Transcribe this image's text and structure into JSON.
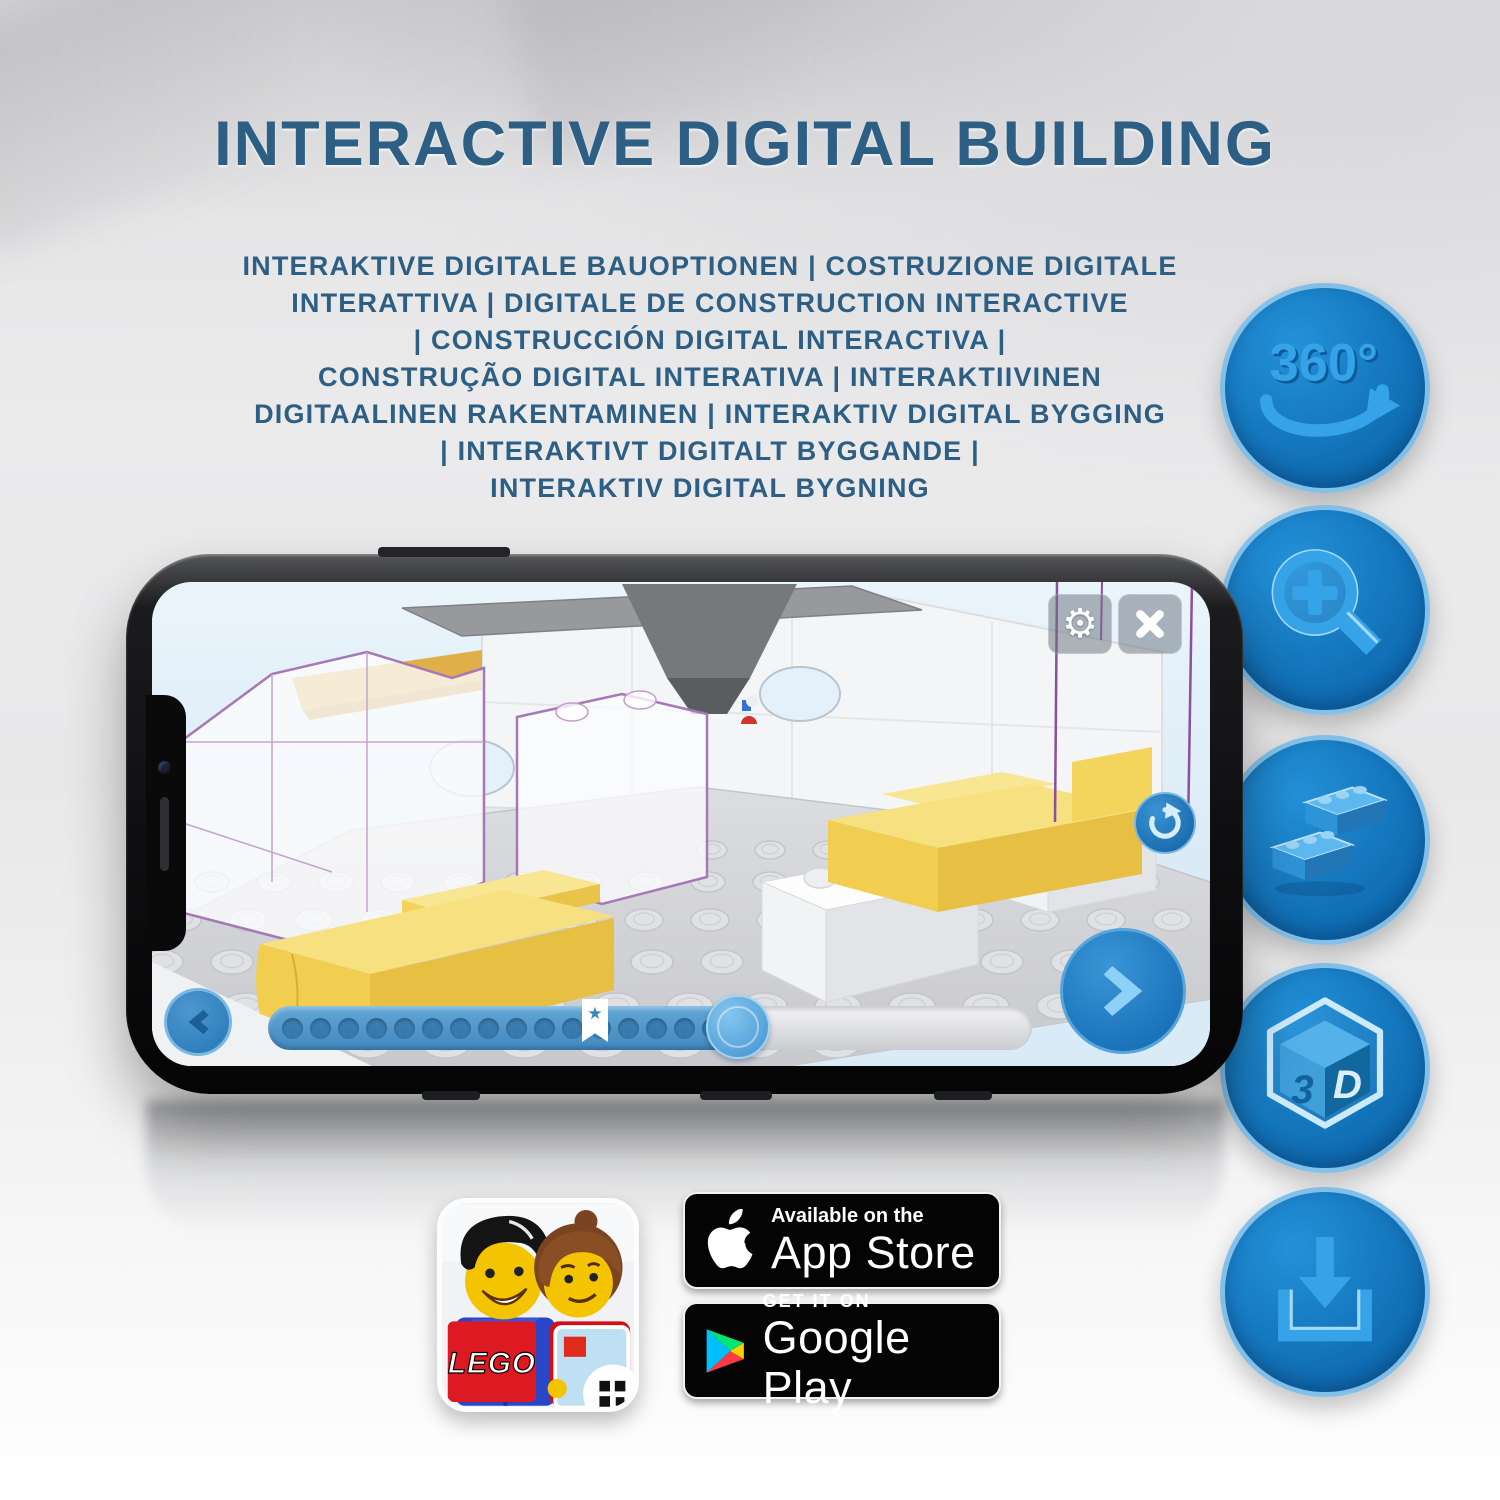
{
  "header": {
    "title": "INTERACTIVE DIGITAL BUILDING"
  },
  "subtitle_lines": [
    "INTERAKTIVE DIGITALE BAUOPTIONEN | COSTRUZIONE DIGITALE",
    "INTERATTIVA | DIGITALE DE CONSTRUCTION INTERACTIVE",
    "| CONSTRUCCIÓN DIGITAL INTERACTIVA |",
    "CONSTRUÇÃO DIGITAL INTERATIVA | INTERAKTIIVINEN",
    "DIGITAALINEN RAKENTAMINEN | INTERAKTIV DIGITAL BYGGING",
    "| INTERAKTIVT DIGITALT BYGGANDE |",
    "INTERAKTIV DIGITAL BYGNING"
  ],
  "feature_icons": [
    {
      "name": "360-rotation",
      "icon": "rotate-360-arrow",
      "label": "360°"
    },
    {
      "name": "zoom",
      "icon": "magnifier-plus"
    },
    {
      "name": "digital-bricks",
      "icon": "two-lego-bricks"
    },
    {
      "name": "3d-view",
      "icon": "3d-cube",
      "cube_left": "3",
      "cube_right": "D"
    },
    {
      "name": "download",
      "icon": "download-tray-arrow"
    }
  ],
  "phone_app": {
    "top_buttons": {
      "settings_icon": "gear",
      "settings_glyph": "⚙",
      "close_icon": "x-mark"
    },
    "viewer_buttons": {
      "rotate_icon": "rotate-clockwise-arrow",
      "previous_icon": "chevron-left",
      "next_icon": "chevron-right"
    },
    "progress_bar": {
      "dot_count": 16,
      "filled_percent": 62,
      "bookmark_icon": "star-bookmark",
      "bookmark_glyph": "★"
    }
  },
  "app_links": {
    "lego_app_icon": {
      "wordmark": "LEGO"
    },
    "app_store_badge": {
      "logo_icon": "apple-logo",
      "tagline": "Available on the",
      "store_name": "App Store"
    },
    "google_play_badge": {
      "logo_icon": "google-play-triangle",
      "tagline": "GET IT ON",
      "store_name": "Google Play"
    }
  },
  "colors": {
    "title_blue": "#2d5e84",
    "feature_circle_blue": "#1074bd",
    "icon_glyph_blue": "#33a0e6",
    "app_accent_blue": "#2a82c6",
    "lego_red": "#dd1a21",
    "badge_black": "#000000",
    "screen_sky": "#d9ecf8",
    "brick_yellow": "#f2cf52"
  }
}
